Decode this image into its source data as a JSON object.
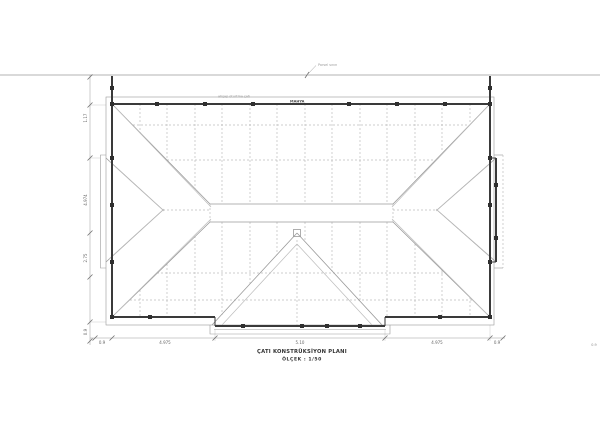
{
  "annotations": {
    "property_line_label": "Parsel sınırı",
    "roof_note": "ahşap oturtma çatı",
    "wall_note": "MAHYA"
  },
  "title_block": {
    "line1": "ÇATI KONSTRÜKSİYON PLANI",
    "line2": "ÖLÇEK : 1/50"
  },
  "dimensions": {
    "left": [
      "1.17",
      "4.974",
      "2.75",
      "0.9"
    ],
    "bottom": [
      "0.9",
      "4.975",
      "5.10",
      "4.975",
      "0.9"
    ],
    "bottom_right_extra": "0.9"
  },
  "colors": {
    "line_light": "#bcbcbc",
    "line_mid": "#9a9a9a",
    "wall": "#3a3a3a",
    "text": "#6a6a6a",
    "title": "#333333",
    "bg": "#ffffff"
  }
}
